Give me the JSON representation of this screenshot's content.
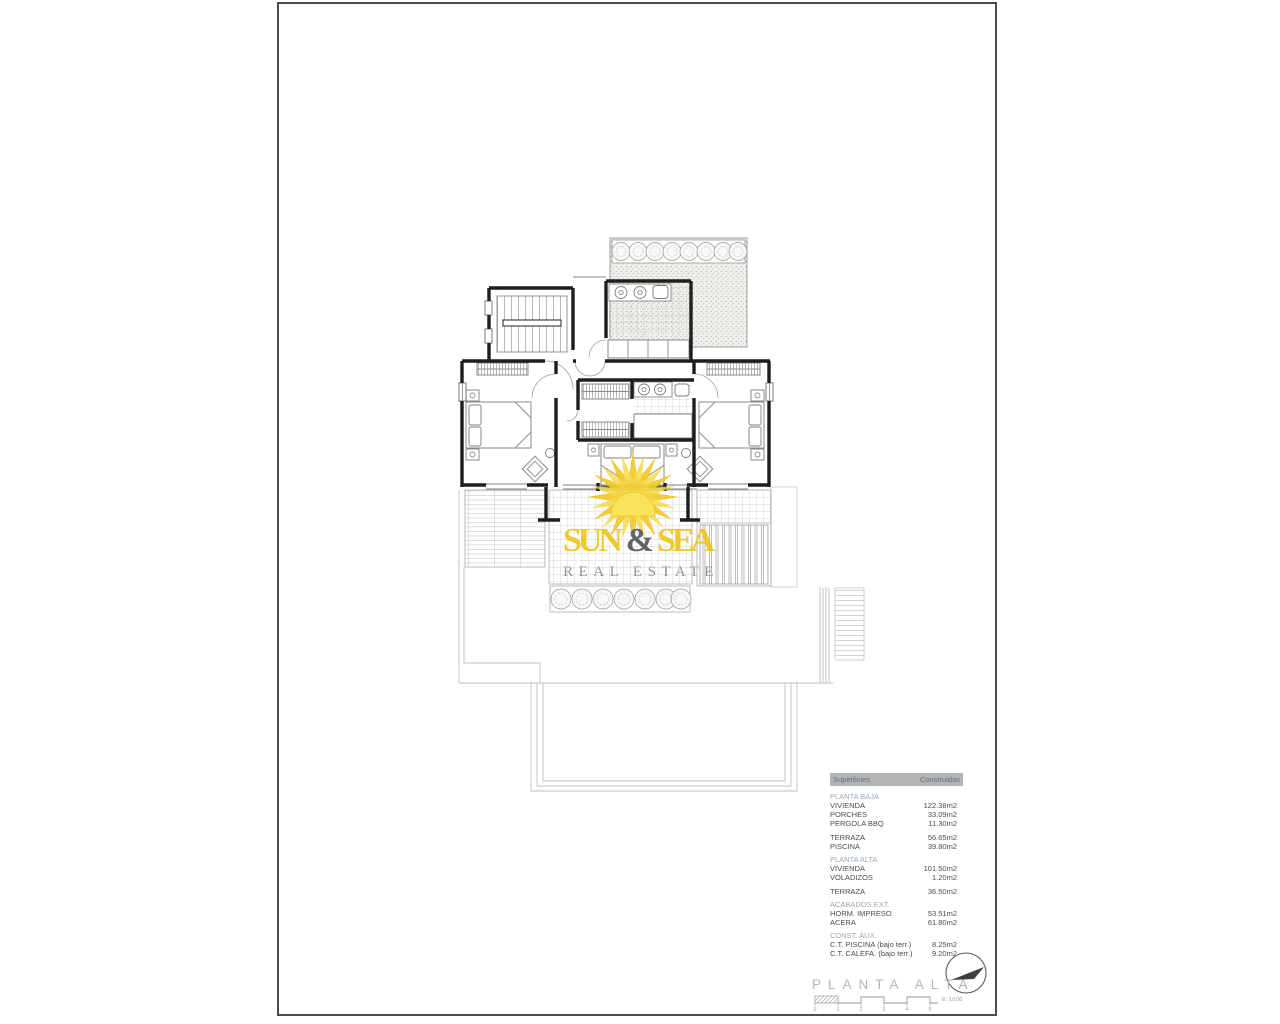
{
  "page": {
    "title_block": {
      "title": "PLANTA ALTA",
      "scale_label": "E: 1/100",
      "scale_ticks": [
        "0",
        "1",
        "2",
        "3",
        "4",
        "5"
      ]
    },
    "logo": {
      "word1": "SUN",
      "amp": "&",
      "word2": "SEA",
      "subtitle": "REAL ESTATE",
      "colors": {
        "yellow": "#EEC522",
        "dark": "#55585D",
        "subtitle_gray": "#8B8D90"
      }
    },
    "surfaces_table": {
      "header": {
        "col1": "Superficies",
        "col2": "Construidas"
      },
      "colors": {
        "header_bg": "#B2B4B6",
        "header_text": "#5E6F80",
        "section_text": "#9BAAB4",
        "item_text": "#4C4C4C"
      },
      "rows": [
        {
          "type": "section",
          "label": "PLANTA BAJA"
        },
        {
          "type": "item",
          "label": "VIVIENDA",
          "value": "122.38m2"
        },
        {
          "type": "item",
          "label": "PORCHES",
          "value": "33.09m2"
        },
        {
          "type": "item",
          "label": "PERGOLA BBQ",
          "value": "11.30m2"
        },
        {
          "type": "gap"
        },
        {
          "type": "item",
          "label": "TERRAZA",
          "value": "56.65m2"
        },
        {
          "type": "item",
          "label": "PISCINA",
          "value": "39.80m2"
        },
        {
          "type": "section",
          "label": "PLANTA ALTA"
        },
        {
          "type": "item",
          "label": "VIVIENDA",
          "value": "101.50m2"
        },
        {
          "type": "item",
          "label": "VOLADIZOS",
          "value": "1.20m2"
        },
        {
          "type": "gap"
        },
        {
          "type": "item",
          "label": "TERRAZA",
          "value": "36.50m2"
        },
        {
          "type": "section",
          "label": "ACABADOS EXT."
        },
        {
          "type": "item",
          "label": "HORM. IMPRESO",
          "value": "53.51m2"
        },
        {
          "type": "item",
          "label": "ACERA",
          "value": "61.80m2"
        },
        {
          "type": "section",
          "label": "CONST. AUX."
        },
        {
          "type": "item",
          "label": "C.T. PISCINA (bajo terr.)",
          "value": "8.25m2"
        },
        {
          "type": "item",
          "label": "C.T. CALEFA. (bajo terr.)",
          "value": "9.20m2"
        }
      ]
    }
  }
}
